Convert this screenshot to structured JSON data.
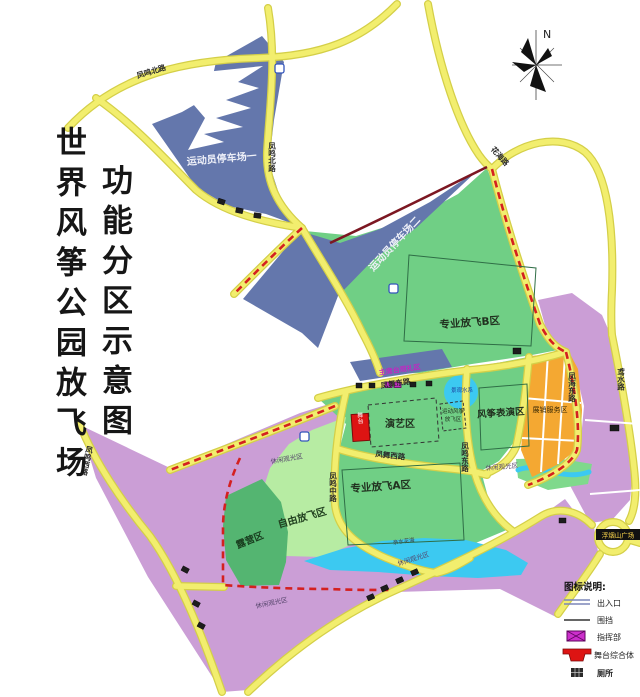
{
  "title": {
    "line1": "世界风筝公园放飞场",
    "line2": "功能分区示意图"
  },
  "compass": {
    "north_label": "N"
  },
  "zones": {
    "parking1": "运动员停车场一",
    "parking2": "运动员停车场二",
    "proB": "专业放飞B区",
    "proA": "专业放飞A区",
    "performance": "演艺区",
    "sportKiteLine1": "运动风筝",
    "sportKiteLine2": "放飞区",
    "kiteShow": "风筝表演区",
    "expo": "展销服务区",
    "freeFly": "自由放飞区",
    "camping": "露营区",
    "leisure": "休闲观光区",
    "viewingStand": "主席台观礼区",
    "waterSystem": "景观水系",
    "flowerSea": "亲水花海",
    "stage": "舞台"
  },
  "roads": {
    "fengmingNorth": "凤鸣北路",
    "fengmingMiddle": "凤鸣中路",
    "fengmingEast": "凤鸣东路",
    "fengmingWest": "凤鸣西路",
    "fengwuEast": "凤舞东路",
    "fengwuWest": "凤舞西路",
    "fenghaiEast": "凤海东路",
    "huahai": "花海路",
    "yuanshui": "鸢水路",
    "plazaBadge": "浮烟山广场"
  },
  "legend": {
    "title": "图标说明:",
    "items": [
      {
        "label": "出入口"
      },
      {
        "label": "围挡"
      },
      {
        "label": "指挥部"
      },
      {
        "label": "舞台综合体"
      },
      {
        "label": "厕所"
      }
    ]
  },
  "colors": {
    "road": "#f2ee6e",
    "road_casing": "#d4cf48",
    "purple_zone": "#cb9ed6",
    "green_zone": "#70cf85",
    "light_green_zone": "#b7eca3",
    "dark_green_zone": "#54b571",
    "slate_parking": "#6477ac",
    "orange_zone": "#f4a832",
    "water": "#3cc9f1",
    "boundary_dashed_red": "#d42020",
    "fence_maroon": "#7c1722",
    "stage_red": "#dd1413",
    "command_magenta": "#cc2fcc"
  }
}
